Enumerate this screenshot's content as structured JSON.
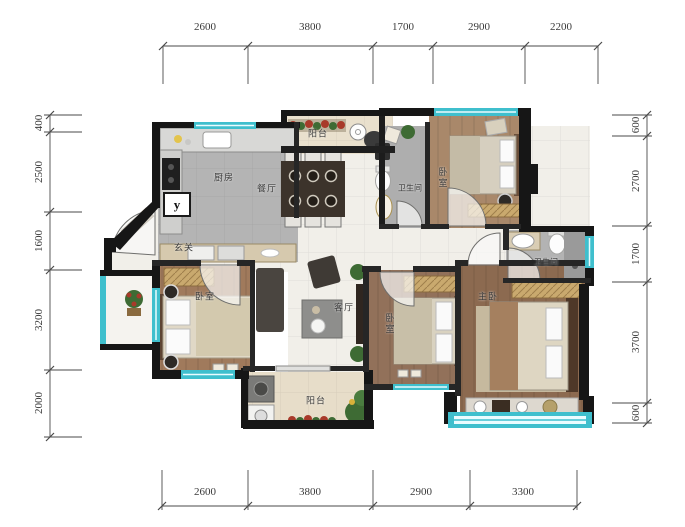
{
  "title": "residential floor plan",
  "dimensions": {
    "top": [
      "2600",
      "3800",
      "1700",
      "2900",
      "2200"
    ],
    "bottom": [
      "2600",
      "3800",
      "2900",
      "3300"
    ],
    "left": [
      "400",
      "2500",
      "1600",
      "3200",
      "2000"
    ],
    "right": [
      "600",
      "2700",
      "1700",
      "3700",
      "600"
    ]
  },
  "rooms": {
    "balcony_top": "阳台",
    "kitchen": "厨房",
    "dining": "餐厅",
    "bath_top": "卫生间",
    "bedroom_top_right": "卧室",
    "bath_right": "卫生间",
    "entry": "玄关",
    "bedroom_left": "卧室",
    "living": "客厅",
    "bedroom_mid": "卧室",
    "master": "主卧",
    "balcony_bottom": "阳台"
  },
  "marker": {
    "label": "y"
  },
  "colors": {
    "wall": "#161616",
    "interior_wall": "#262626",
    "window": "#3fbfcd",
    "marble_floor": "#f1efe9",
    "kitchen_floor": "#b4b4b4",
    "bath_floor": "#aeaeae",
    "wood_light": "#a9886a",
    "wood_dark": "#8c6a50",
    "balcony_floor": "#e9e0cd",
    "wardrobe": "#c9a96e",
    "plant": "#3e6b34",
    "flower": "#a83a2a"
  }
}
